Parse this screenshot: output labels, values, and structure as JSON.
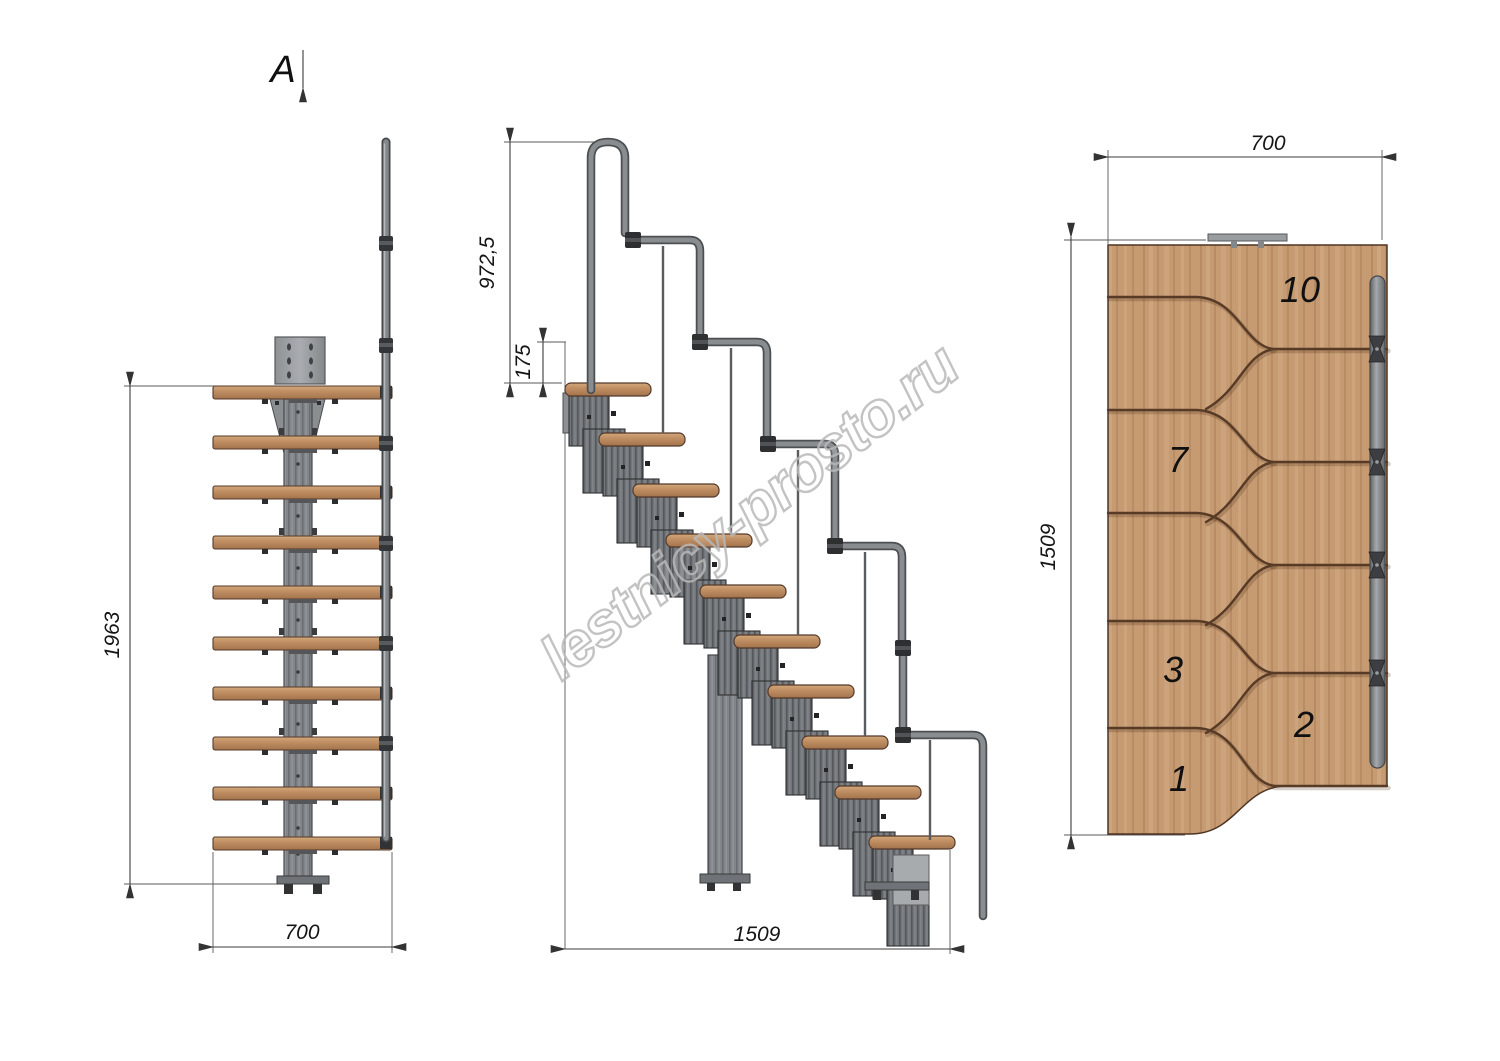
{
  "drawing": {
    "watermark": "lestnicy-prosto.ru",
    "section": {
      "label": "A"
    },
    "front_view": {
      "height_mm": "1963",
      "width_mm": "700"
    },
    "side_view": {
      "handrail_height_mm": "972,5",
      "top_rise_mm": "175",
      "length_mm": "1509"
    },
    "plan_view": {
      "width_mm": "700",
      "length_mm": "1509",
      "step_labels": [
        "10",
        "7",
        "3",
        "2",
        "1"
      ]
    },
    "colors": {
      "wood": "#c69b72",
      "wood_edge": "#54392b",
      "metal": "#73777b",
      "metal_dark": "#4c4f52",
      "tube": "#8a8d90",
      "dim_line": "#3c3c3c",
      "text": "#151515",
      "watermark": "#b9b9b9"
    }
  }
}
